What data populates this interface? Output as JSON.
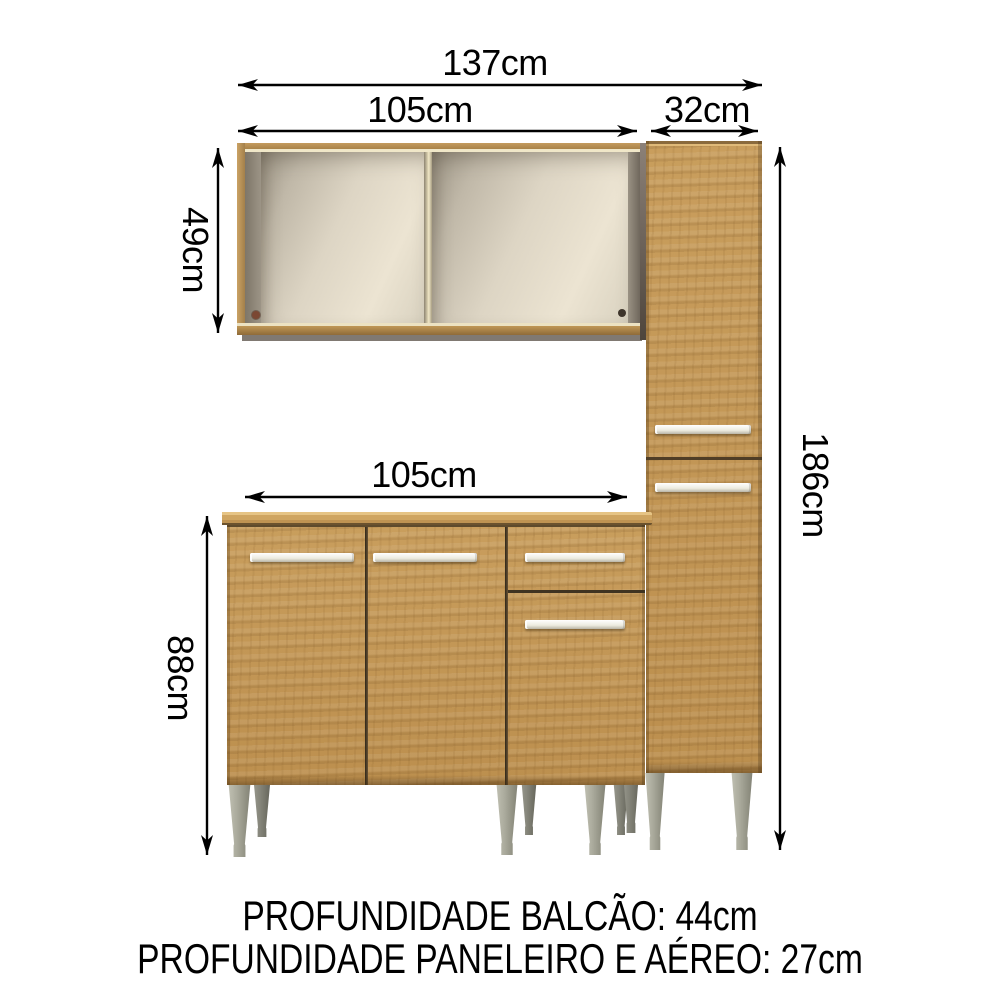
{
  "product_diagram": {
    "labels": {
      "total_width": "137cm",
      "upper_width": "105cm",
      "tall_width": "32cm",
      "upper_height": "49cm",
      "base_width": "105cm",
      "base_height": "88cm",
      "tall_height": "186cm"
    },
    "footer": {
      "line1": "PROFUNDIDADE BALCÃO: 44cm",
      "line2": "PROFUNDIDADE PANELEIRO E AÉREO: 27cm"
    },
    "colors": {
      "background": "#ffffff",
      "wood": "#c09150",
      "wood_dark": "#8f6b38",
      "countertop": "#cfa561",
      "interior_back": "#ddd5c4",
      "handle": "#f4f3ee",
      "leg": "#a6a698",
      "dimension_lines": "#000000"
    }
  }
}
